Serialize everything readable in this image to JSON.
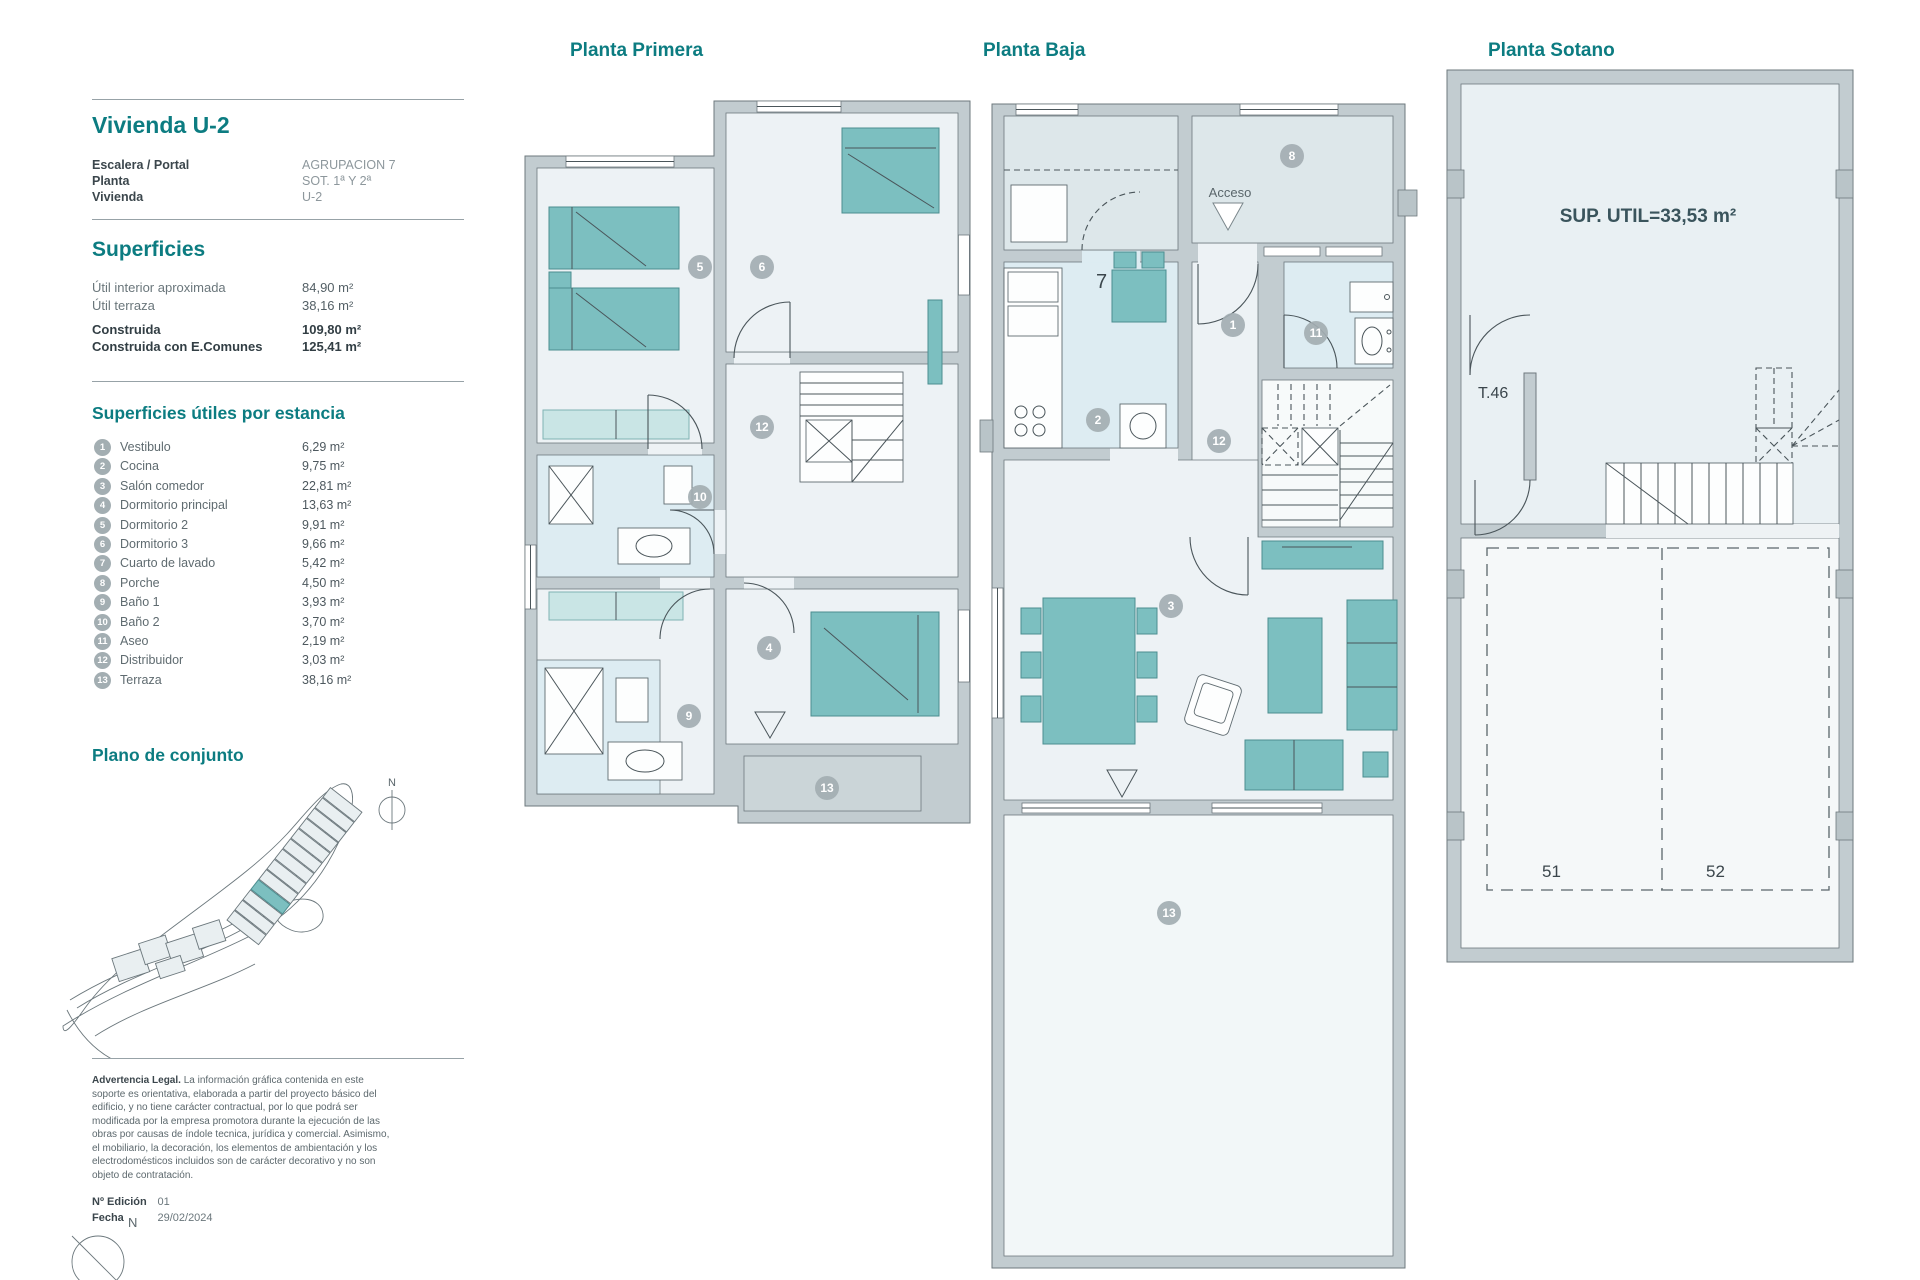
{
  "colors": {
    "teal_heading": "#0c7c81",
    "dark_text": "#3b464c",
    "gray_text": "#6a767b",
    "wall_gray": "#c2ccd0",
    "furniture_teal": "#7cbfc0",
    "marker_gray": "#a3aeb2"
  },
  "sidebar": {
    "unit_title": "Vivienda U-2",
    "info_rows": [
      {
        "label": "Escalera / Portal",
        "value": "AGRUPACION 7"
      },
      {
        "label": "Planta",
        "value": "SOT. 1ª Y 2ª"
      },
      {
        "label": "Vivienda",
        "value": "U-2"
      }
    ],
    "superficies": {
      "heading": "Superficies",
      "rows": [
        {
          "label": "Útil interior aproximada",
          "value": "84,90 m²"
        },
        {
          "label": "Útil terraza",
          "value": "38,16 m²"
        }
      ],
      "bold_rows": [
        {
          "label": "Construida",
          "value": "109,80 m²"
        },
        {
          "label": "Construida con E.Comunes",
          "value": "125,41 m²"
        }
      ]
    },
    "estancias": {
      "heading": "Superficies útiles por estancia",
      "items": [
        {
          "num": "1",
          "label": "Vestibulo",
          "value": "6,29 m²"
        },
        {
          "num": "2",
          "label": "Cocina",
          "value": "9,75 m²"
        },
        {
          "num": "3",
          "label": "Salón comedor",
          "value": "22,81 m²"
        },
        {
          "num": "4",
          "label": "Dormitorio principal",
          "value": "13,63 m²"
        },
        {
          "num": "5",
          "label": "Dormitorio 2",
          "value": "9,91 m²"
        },
        {
          "num": "6",
          "label": "Dormitorio 3",
          "value": "9,66 m²"
        },
        {
          "num": "7",
          "label": "Cuarto de lavado",
          "value": "5,42 m²"
        },
        {
          "num": "8",
          "label": "Porche",
          "value": "4,50 m²"
        },
        {
          "num": "9",
          "label": "Baño 1",
          "value": "3,93 m²"
        },
        {
          "num": "10",
          "label": "Baño 2",
          "value": "3,70 m²"
        },
        {
          "num": "11",
          "label": "Aseo",
          "value": "2,19 m²"
        },
        {
          "num": "12",
          "label": "Distribuidor",
          "value": "3,03 m²"
        },
        {
          "num": "13",
          "label": "Terraza",
          "value": "38,16 m²"
        }
      ]
    },
    "plano_heading": "Plano de conjunto",
    "north_letter": "N",
    "legal": {
      "lead": "Advertencia Legal.",
      "text": " La información gráfica contenida en este soporte es orientativa, elaborada a partir del proyecto básico del edificio, y no tiene carácter contractual, por lo que podrá ser modificada por la empresa promotora durante la ejecución de las obras por causas de índole tecnica, jurídica y comercial. Asimismo, el mobiliario, la decoración, los elementos de ambientación y los electrodomésticos incluidos son de carácter decorativo y no son objeto de contratación."
    },
    "edition": [
      {
        "label": "Nº Edición",
        "value": "01"
      },
      {
        "label": "Fecha",
        "value": "29/02/2024"
      }
    ]
  },
  "plans": {
    "primera": {
      "title": "Planta Primera",
      "markers": [
        "5",
        "6",
        "12",
        "10",
        "4",
        "9",
        "13"
      ]
    },
    "baja": {
      "title": "Planta Baja",
      "acceso_label": "Acceso",
      "kitchen_number": "7",
      "markers": [
        "8",
        "1",
        "11",
        "2",
        "12",
        "3",
        "13"
      ]
    },
    "sotano": {
      "title": "Planta Sotano",
      "sup_util": "SUP. UTIL=33,53 m²",
      "trastero_label": "T.46",
      "parking_spaces": [
        "51",
        "52"
      ]
    }
  }
}
